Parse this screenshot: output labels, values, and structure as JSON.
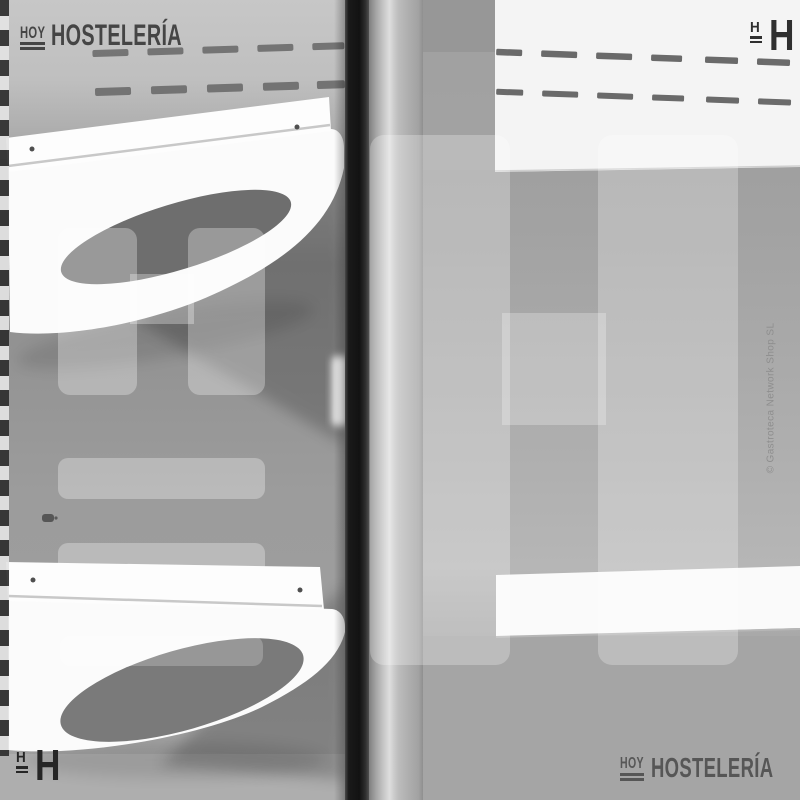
{
  "branding": {
    "hoy_text": "HOY",
    "name_text": "HOSTELERÍA",
    "icon_letter": "H"
  },
  "watermark": {
    "letter": "H",
    "color": "#ffffff"
  },
  "copyright_text": "© Gastroteca Network Shop SL",
  "photo": {
    "subject": "grayscale close-up of display-cabinet interior with two white shelf brackets and centre door post",
    "colors": {
      "wall_light": "#c6c6c6",
      "wall_mid": "#9a9a9a",
      "bracket_white": "#fcfcfc",
      "oval_cutout": "#6e6e6e",
      "door_post_black": "#141414",
      "pillar_highlight": "#dedede",
      "canopy_white": "#f4f4f4",
      "shelf_white": "#fafafa",
      "logo_dark": "#454545",
      "icon_dark": "#2a2a2a",
      "copyright_gray": "#8e8e8e"
    }
  }
}
